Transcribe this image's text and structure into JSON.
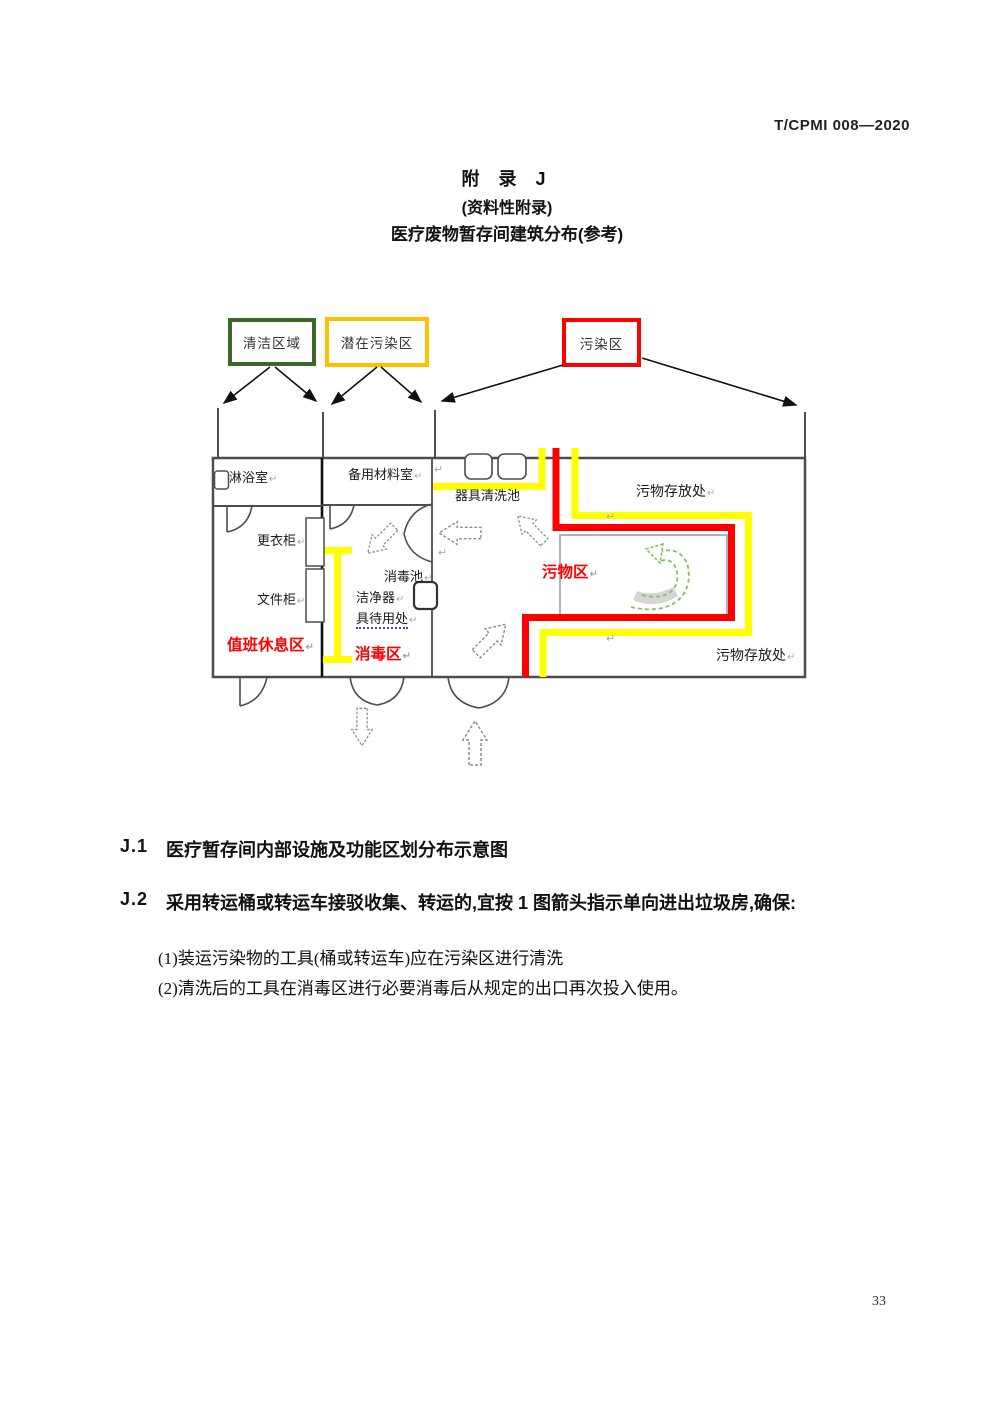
{
  "header": {
    "standard_code": "T/CPMI 008—2020"
  },
  "title": {
    "appendix": "附 录 J",
    "type_note": "(资料性附录)",
    "subject": "医疗废物暂存间建筑分布(参考)"
  },
  "legend": {
    "clean_label": "清洁区域",
    "potential_label": "潜在污染区",
    "contaminated_label": "污染区",
    "clean_color": "#3E6629",
    "potential_color": "#FFC000",
    "contaminated_color": "#FF0000"
  },
  "plan": {
    "labels": {
      "shower_room": "淋浴室",
      "spare_material_room": "备用材料室",
      "tool_washing_pool": "器具清洗池",
      "waste_storage_top": "污物存放处",
      "wardrobe": "更衣柜",
      "disinfection_pool": "消毒池",
      "clean_tool_line1": "洁净器",
      "clean_tool_line2": "具待用处",
      "file_cabinet": "文件柜",
      "duty_rest_area": "值班休息区",
      "disinfection_area": "消毒区",
      "waste_area": "污物区",
      "waste_storage_bottom": "污物存放处"
    },
    "return_mark": "↵",
    "colors": {
      "potential_boundary": "#FFFF00",
      "contaminated_boundary": "#FF0000",
      "flow_arrow_green": "#7DC35A",
      "wall": "#4d4d4d"
    }
  },
  "body": {
    "j1_label": "J.1",
    "j1_text": "医疗暂存间内部设施及功能区划分布示意图",
    "j2_label": "J.2",
    "j2_text": "采用转运桶或转运车接驳收集、转运的,宜按 1 图箭头指示单向进出垃圾房,确保:",
    "item1": "(1)装运污染物的工具(桶或转运车)应在污染区进行清洗",
    "item2": "(2)清洗后的工具在消毒区进行必要消毒后从规定的出口再次投入使用。"
  },
  "footer": {
    "page_number": "33"
  }
}
